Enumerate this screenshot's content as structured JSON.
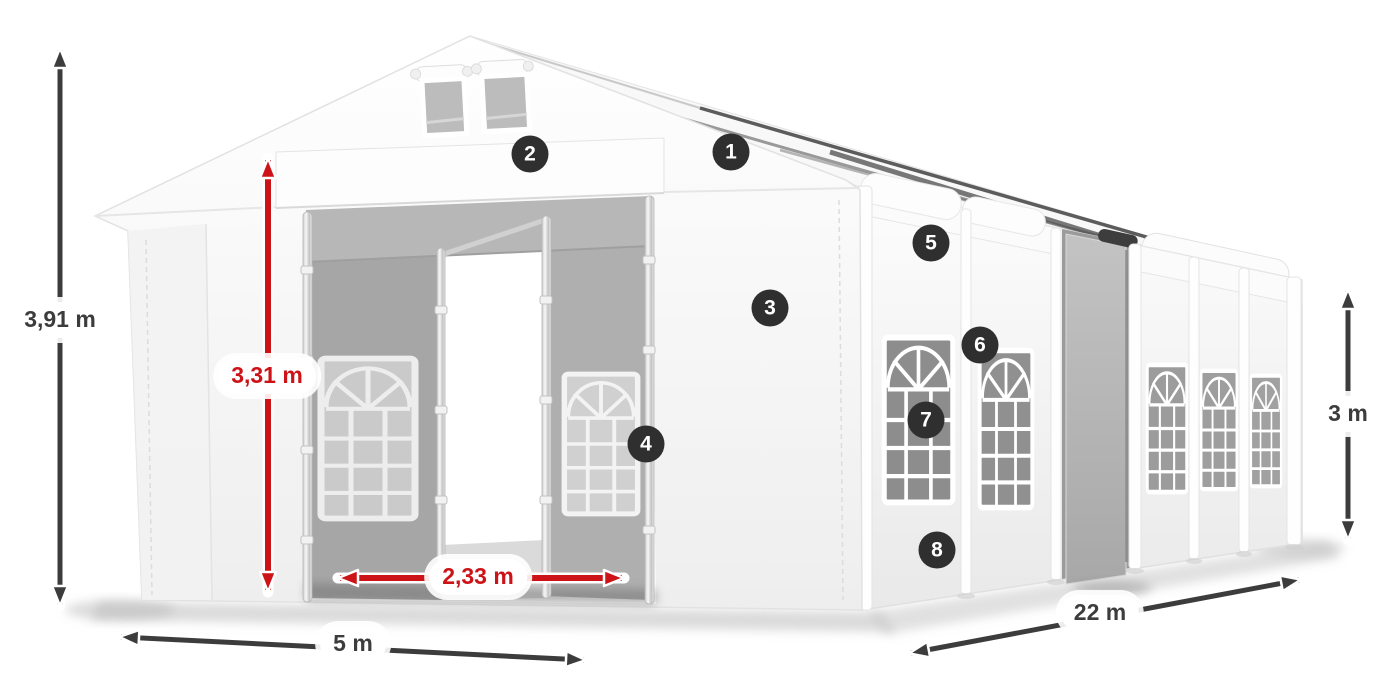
{
  "diagram": {
    "subject": "party-tent-dimension-diagram"
  },
  "colors": {
    "dim_red": "#cc1418",
    "dim_dark": "#3c3c3c",
    "badge_bg": "#2f2f2f",
    "badge_text": "#ffffff"
  },
  "dimensions": {
    "total_height": {
      "label": "3,91 m"
    },
    "entrance_height": {
      "label": "3,31 m"
    },
    "entrance_width": {
      "label": "2,33 m"
    },
    "front_width": {
      "label": "5 m"
    },
    "side_length": {
      "label": "22 m"
    },
    "side_height": {
      "label": "3 m"
    }
  },
  "badges": [
    {
      "label": "1"
    },
    {
      "label": "2"
    },
    {
      "label": "3"
    },
    {
      "label": "4"
    },
    {
      "label": "5"
    },
    {
      "label": "6"
    },
    {
      "label": "7"
    },
    {
      "label": "8"
    }
  ]
}
